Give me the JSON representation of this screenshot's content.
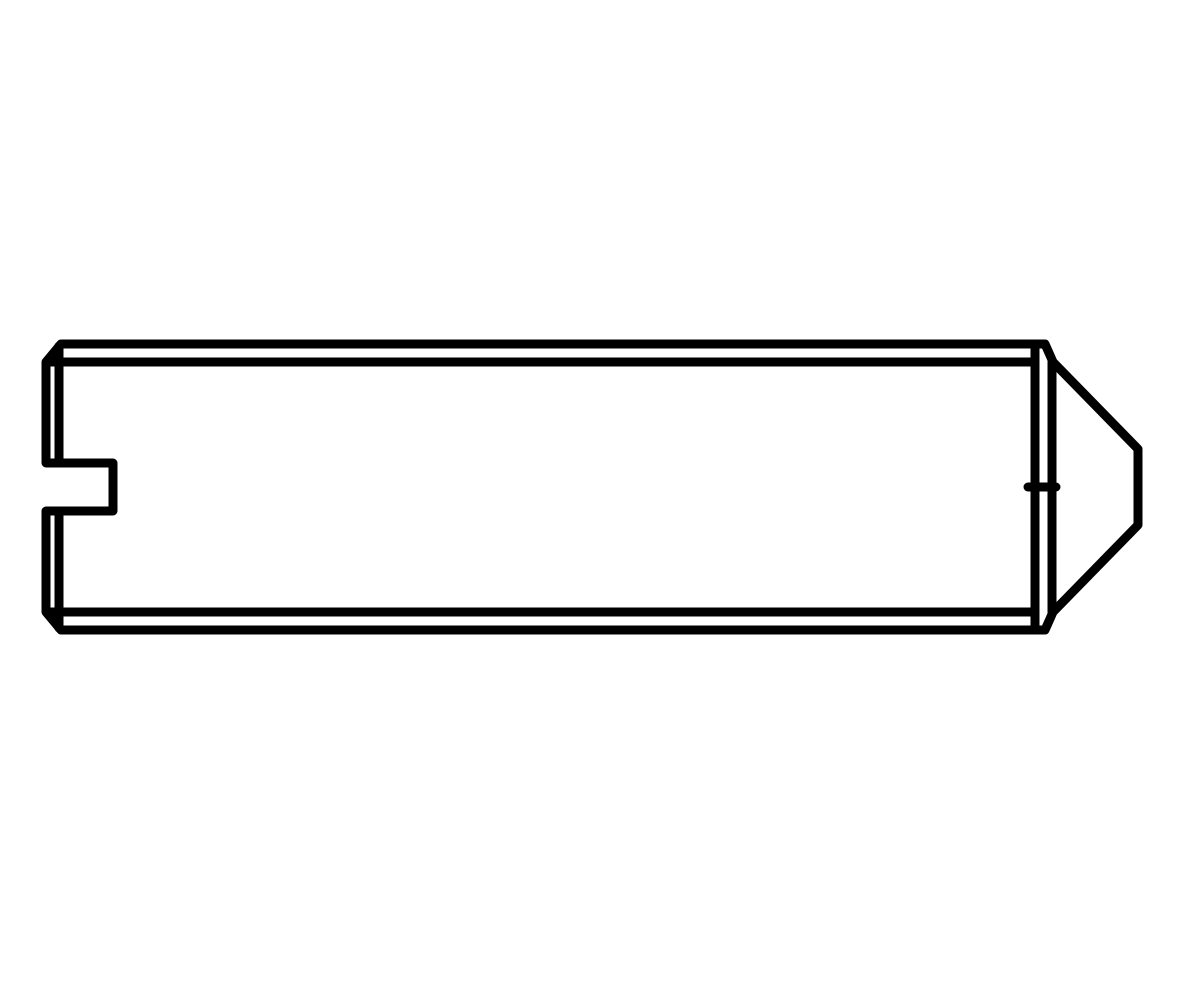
{
  "page": {
    "background_color": "#ffffff",
    "subject": "Side-view technical line drawing of a slotted set screw with cone point"
  },
  "drawing": {
    "stroke_color": "#000000",
    "body_fill_color": "#ffffff",
    "stroke_width": 9,
    "canvas_width": 1200,
    "canvas_height": 1000,
    "shapes": [
      {
        "name": "screw-outline",
        "type": "path",
        "fill": "#ffffff",
        "d": "M 61 344 L 1045 344 L 1053 362 L 1138 449 L 1138 525 L 1053 612 L 1045 630 L 61 630 L 46 612 L 46 511 L 113 511 L 113 463 L 46 463 L 46 362 Z"
      },
      {
        "name": "thread-line-top",
        "type": "line",
        "x1": 50,
        "y1": 362,
        "x2": 1035,
        "y2": 362
      },
      {
        "name": "thread-line-bottom",
        "type": "line",
        "x1": 50,
        "y1": 612,
        "x2": 1035,
        "y2": 612
      },
      {
        "name": "left-chamfer-edge-upper",
        "type": "line",
        "x1": 59,
        "y1": 346,
        "x2": 59,
        "y2": 461
      },
      {
        "name": "left-chamfer-edge-lower",
        "type": "line",
        "x1": 59,
        "y1": 513,
        "x2": 59,
        "y2": 628
      },
      {
        "name": "body-end-edge",
        "type": "line",
        "x1": 1035,
        "y1": 344,
        "x2": 1035,
        "y2": 630
      },
      {
        "name": "cone-base-edge",
        "type": "line",
        "x1": 1052,
        "y1": 362,
        "x2": 1052,
        "y2": 612
      },
      {
        "name": "center-mark",
        "type": "line",
        "x1": 1028,
        "y1": 487,
        "x2": 1056,
        "y2": 487
      }
    ]
  }
}
